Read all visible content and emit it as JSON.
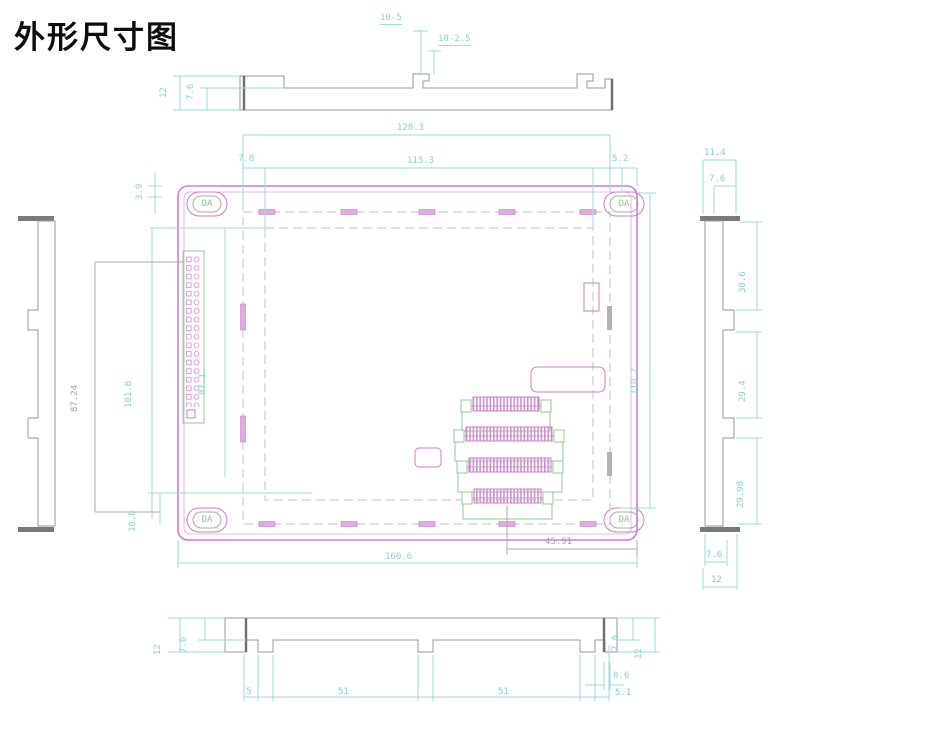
{
  "title": "外形尺寸图",
  "colors": {
    "outline_magenta": "#c97fc9",
    "dimension_cyan": "#9fd9d9",
    "profile_gray": "#9a9a9a",
    "accent_green": "#94c894"
  },
  "views": {
    "front": {
      "hole_label": "DA",
      "dims": {
        "width_top": "128.3",
        "edge_left": "7.8",
        "width_inner": "115.3",
        "edge_right": "5.2",
        "corner_offset": "3.9",
        "connector_height": "87.24",
        "inner_height_a": "101.8",
        "inner_height_b": "87.1",
        "edge_bottom": "10.8",
        "height_inner": "110.2",
        "connector_offset": "45.91",
        "width_total": "160.6"
      }
    },
    "top_profile": {
      "dims": {
        "height_total": "12",
        "bar_height": "7.6",
        "tab_note": "10-5",
        "slot_note": "10-2.5"
      }
    },
    "right_profile": {
      "dims": {
        "width_top": "11.4",
        "lip_top": "7.6",
        "segment_upper": "30.6",
        "segment_middle": "29.4",
        "segment_lower": "29.98",
        "lip_bottom": "7.6",
        "width_bottom": "12"
      }
    },
    "bottom_profile": {
      "dims": {
        "height_left": "12",
        "bar_left": "7.6",
        "tab_left": "5",
        "slot_a": "51",
        "slot_b": "51",
        "lip_right": "0.6",
        "tab_right": "5.1",
        "bar_right": "7.6",
        "height_right": "12"
      }
    }
  }
}
